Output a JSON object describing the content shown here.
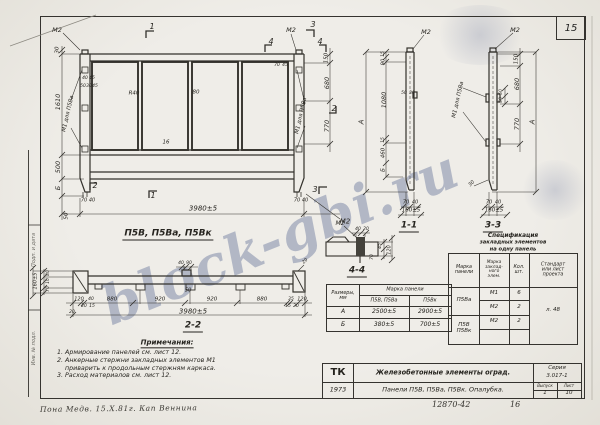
{
  "sheet": {
    "page_number": "15",
    "doc_number": "12870-42",
    "doc_sheet": "16",
    "handwritten": "Пона Медв.    15.Х.81г.    Кап Веннина",
    "stamp_top": "Подп. и дата",
    "stamp_bottom": "Инв. № подл."
  },
  "watermark": {
    "text": "block-gbi.ru",
    "color": "#5f6e96"
  },
  "notes": {
    "title": "Примечания:",
    "lines": [
      "1. Армирование панелей см. лист 12.",
      "2. Анкерные стержни закладных элементов М1",
      "    приварить к продольным стержням каркаса.",
      "3. Расход материалов см. лист 12."
    ]
  },
  "dims_table": {
    "corner": "Размеры,\nмм",
    "header": "Марка панели",
    "sub_headers": [
      "П5В, П5Ва",
      "П5Вк"
    ],
    "rows": [
      {
        "dim": "А",
        "v1": "2500±5",
        "v2": "2900±5"
      },
      {
        "dim": "Б",
        "v1": "380±5",
        "v2": "700±5"
      }
    ]
  },
  "spec_table": {
    "title_lines": [
      "Спецификация",
      "закладных элементов",
      "на одну панель"
    ],
    "col_headers": [
      "Марка\nпанели",
      "Марка\nзаклад-\nного\nэлем.",
      "Кол.\nшт.",
      "Стандарт\nили лист\nпроекта"
    ],
    "groups": [
      {
        "panel": "П5Ва",
        "items": [
          {
            "mark": "М1",
            "qty": "6"
          },
          {
            "mark": "М2",
            "qty": "2"
          }
        ]
      },
      {
        "panel_lines": "П5В\nП5Вк",
        "items": [
          {
            "mark": "М2",
            "qty": "2"
          }
        ]
      }
    ],
    "standard": "л. 48"
  },
  "title_block": {
    "org": "ТК",
    "title": "Железобетонные элементы оград.",
    "series_label": "Серия",
    "series": "3.017-1",
    "year": "1973",
    "subtitle": "Панели П5В, П5Ва, П5Вк. Опалубка.",
    "issue_label": "Выпуск",
    "issue": "1",
    "sheet_label": "Лист",
    "sheet": "10"
  },
  "labels": [
    {
      "t": "М2",
      "x": 57,
      "y": 30
    },
    {
      "t": "1",
      "x": 152,
      "y": 27,
      "s": 8
    },
    {
      "t": "М2",
      "x": 291,
      "y": 30
    },
    {
      "t": "3",
      "x": 313,
      "y": 25,
      "s": 8
    },
    {
      "t": "4",
      "x": 271,
      "y": 42,
      "s": 8
    },
    {
      "t": "4",
      "x": 320,
      "y": 42,
      "s": 8
    },
    {
      "t": "70",
      "x": 277,
      "y": 66,
      "s": 4.5
    },
    {
      "t": "45",
      "x": 285,
      "y": 66,
      "s": 4.5
    },
    {
      "t": "30",
      "x": 58,
      "y": 50,
      "r": -90,
      "s": 5.5
    },
    {
      "t": "1610",
      "x": 58,
      "y": 102,
      "r": -90
    },
    {
      "t": "500",
      "x": 58,
      "y": 167,
      "r": -90
    },
    {
      "t": "Б",
      "x": 58,
      "y": 188,
      "r": -90
    },
    {
      "t": "50",
      "x": 67,
      "y": 216,
      "r": -90,
      "s": 5.5
    },
    {
      "t": "М1 для П5Ва",
      "x": 69,
      "y": 114,
      "r": -77,
      "s": 5.5
    },
    {
      "t": "40",
      "x": 85,
      "y": 79,
      "s": 4.5
    },
    {
      "t": "45",
      "x": 92,
      "y": 79,
      "s": 4.5
    },
    {
      "t": "50",
      "x": 83,
      "y": 87,
      "s": 4.5
    },
    {
      "t": "30",
      "x": 89,
      "y": 87,
      "s": 4.5
    },
    {
      "t": "45",
      "x": 95,
      "y": 87,
      "s": 4.5
    },
    {
      "t": "R40",
      "x": 134,
      "y": 94,
      "s": 5.5
    },
    {
      "t": "80",
      "x": 196,
      "y": 93,
      "s": 5.5
    },
    {
      "t": "16",
      "x": 166,
      "y": 143,
      "s": 5.5
    },
    {
      "t": "150",
      "x": 327,
      "y": 58,
      "r": -90,
      "s": 5.5
    },
    {
      "t": "680",
      "x": 327,
      "y": 83,
      "r": -90
    },
    {
      "t": "2",
      "x": 334,
      "y": 109,
      "s": 8
    },
    {
      "t": "770",
      "x": 327,
      "y": 126,
      "r": -90
    },
    {
      "t": "М1 для П5Ва",
      "x": 302,
      "y": 116,
      "r": -77,
      "s": 5.5
    },
    {
      "t": "2",
      "x": 95,
      "y": 186,
      "s": 8
    },
    {
      "t": "70",
      "x": 84,
      "y": 201,
      "s": 5
    },
    {
      "t": "40",
      "x": 92,
      "y": 201,
      "s": 5
    },
    {
      "t": "1",
      "x": 153,
      "y": 196,
      "s": 8
    },
    {
      "t": "3",
      "x": 315,
      "y": 190,
      "s": 8
    },
    {
      "t": "70",
      "x": 297,
      "y": 201,
      "s": 5
    },
    {
      "t": "40",
      "x": 305,
      "y": 201,
      "s": 5
    },
    {
      "t": "3980±5",
      "x": 203,
      "y": 209,
      "s": 7
    },
    {
      "t": "М2",
      "x": 345,
      "y": 222,
      "s": 7
    },
    {
      "t": "П5В, П5Ва, П5Вк",
      "x": 168,
      "y": 235,
      "s": 9,
      "cls": "cap"
    },
    {
      "t": "М2",
      "x": 426,
      "y": 32
    },
    {
      "t": "А",
      "x": 362,
      "y": 122,
      "r": -90,
      "s": 7
    },
    {
      "t": "15",
      "x": 384,
      "y": 54,
      "r": -90,
      "s": 4.5
    },
    {
      "t": "90",
      "x": 384,
      "y": 62,
      "r": -90,
      "s": 5
    },
    {
      "t": "1080",
      "x": 384,
      "y": 100,
      "r": -90
    },
    {
      "t": "15",
      "x": 384,
      "y": 140,
      "r": -90,
      "s": 4.5
    },
    {
      "t": "460",
      "x": 384,
      "y": 153,
      "r": -90,
      "s": 5.5
    },
    {
      "t": "Б",
      "x": 384,
      "y": 170,
      "r": -90,
      "s": 5.5
    },
    {
      "t": "50",
      "x": 404,
      "y": 94,
      "s": 4.5
    },
    {
      "t": "30",
      "x": 412,
      "y": 94,
      "s": 4.5
    },
    {
      "t": "70",
      "x": 406,
      "y": 203,
      "s": 5
    },
    {
      "t": "40",
      "x": 415,
      "y": 203,
      "s": 5
    },
    {
      "t": "160±5",
      "x": 411,
      "y": 211,
      "s": 5.5
    },
    {
      "t": "1-1",
      "x": 409,
      "y": 227,
      "s": 9,
      "cls": "cap"
    },
    {
      "t": "М2",
      "x": 515,
      "y": 30
    },
    {
      "t": "М1 для П5Ва",
      "x": 459,
      "y": 100,
      "r": -77,
      "s": 5.5
    },
    {
      "t": "150",
      "x": 517,
      "y": 59,
      "r": -90,
      "s": 5.5
    },
    {
      "t": "680",
      "x": 517,
      "y": 84,
      "r": -90
    },
    {
      "t": "50",
      "x": 502,
      "y": 92,
      "r": -90,
      "s": 4.5
    },
    {
      "t": "50",
      "x": 502,
      "y": 100,
      "r": -90,
      "s": 4.5
    },
    {
      "t": "770",
      "x": 517,
      "y": 124,
      "r": -90
    },
    {
      "t": "А",
      "x": 533,
      "y": 122,
      "r": -90,
      "s": 7
    },
    {
      "t": "30",
      "x": 472,
      "y": 184,
      "r": -45,
      "s": 5
    },
    {
      "t": "70",
      "x": 489,
      "y": 203,
      "s": 5
    },
    {
      "t": "40",
      "x": 498,
      "y": 203,
      "s": 5
    },
    {
      "t": "160±5",
      "x": 494,
      "y": 211,
      "s": 5.5
    },
    {
      "t": "3-3",
      "x": 493,
      "y": 227,
      "s": 9,
      "cls": "cap"
    },
    {
      "t": "М2",
      "x": 340,
      "y": 224,
      "s": 6
    },
    {
      "t": "40",
      "x": 358,
      "y": 230,
      "s": 4.5
    },
    {
      "t": "20",
      "x": 366,
      "y": 230,
      "s": 4.5
    },
    {
      "t": "45",
      "x": 381,
      "y": 246,
      "r": -90,
      "s": 4.5
    },
    {
      "t": "120",
      "x": 390,
      "y": 250,
      "r": -90,
      "s": 5
    },
    {
      "t": "70",
      "x": 373,
      "y": 257,
      "r": -90,
      "s": 4.5
    },
    {
      "t": "4-4",
      "x": 357,
      "y": 272,
      "s": 9,
      "cls": "cap"
    },
    {
      "t": "160±5",
      "x": 36,
      "y": 281,
      "r": -90,
      "s": 5
    },
    {
      "t": "80",
      "x": 49,
      "y": 273,
      "r": -90,
      "s": 4.5
    },
    {
      "t": "10",
      "x": 49,
      "y": 281,
      "r": -90,
      "s": 4.5
    },
    {
      "t": "70",
      "x": 49,
      "y": 289,
      "r": -90,
      "s": 4.5
    },
    {
      "t": "40",
      "x": 181,
      "y": 264,
      "s": 4.5
    },
    {
      "t": "90",
      "x": 189,
      "y": 264,
      "s": 4.5
    },
    {
      "t": "50",
      "x": 188,
      "y": 291,
      "s": 5
    },
    {
      "t": "120",
      "x": 79,
      "y": 300,
      "s": 5
    },
    {
      "t": "40",
      "x": 91,
      "y": 300,
      "s": 4.5
    },
    {
      "t": "880",
      "x": 112,
      "y": 300,
      "s": 5.5
    },
    {
      "t": "920",
      "x": 160,
      "y": 300,
      "s": 5.5
    },
    {
      "t": "920",
      "x": 212,
      "y": 300,
      "s": 5.5
    },
    {
      "t": "880",
      "x": 262,
      "y": 300,
      "s": 5.5
    },
    {
      "t": "35",
      "x": 291,
      "y": 300,
      "s": 4.5
    },
    {
      "t": "120",
      "x": 302,
      "y": 300,
      "s": 5
    },
    {
      "t": "20",
      "x": 84,
      "y": 307,
      "s": 4.5
    },
    {
      "t": "15",
      "x": 92,
      "y": 307,
      "s": 4.5
    },
    {
      "t": "15",
      "x": 288,
      "y": 307,
      "s": 4.5
    },
    {
      "t": "20",
      "x": 296,
      "y": 307,
      "s": 4.5
    },
    {
      "t": "20",
      "x": 72,
      "y": 313,
      "s": 4.5
    },
    {
      "t": "20",
      "x": 306,
      "y": 262,
      "r": -45,
      "s": 4.5
    },
    {
      "t": "3980±5",
      "x": 193,
      "y": 312,
      "s": 7
    },
    {
      "t": "2-2",
      "x": 193,
      "y": 327,
      "s": 9,
      "cls": "cap"
    }
  ]
}
